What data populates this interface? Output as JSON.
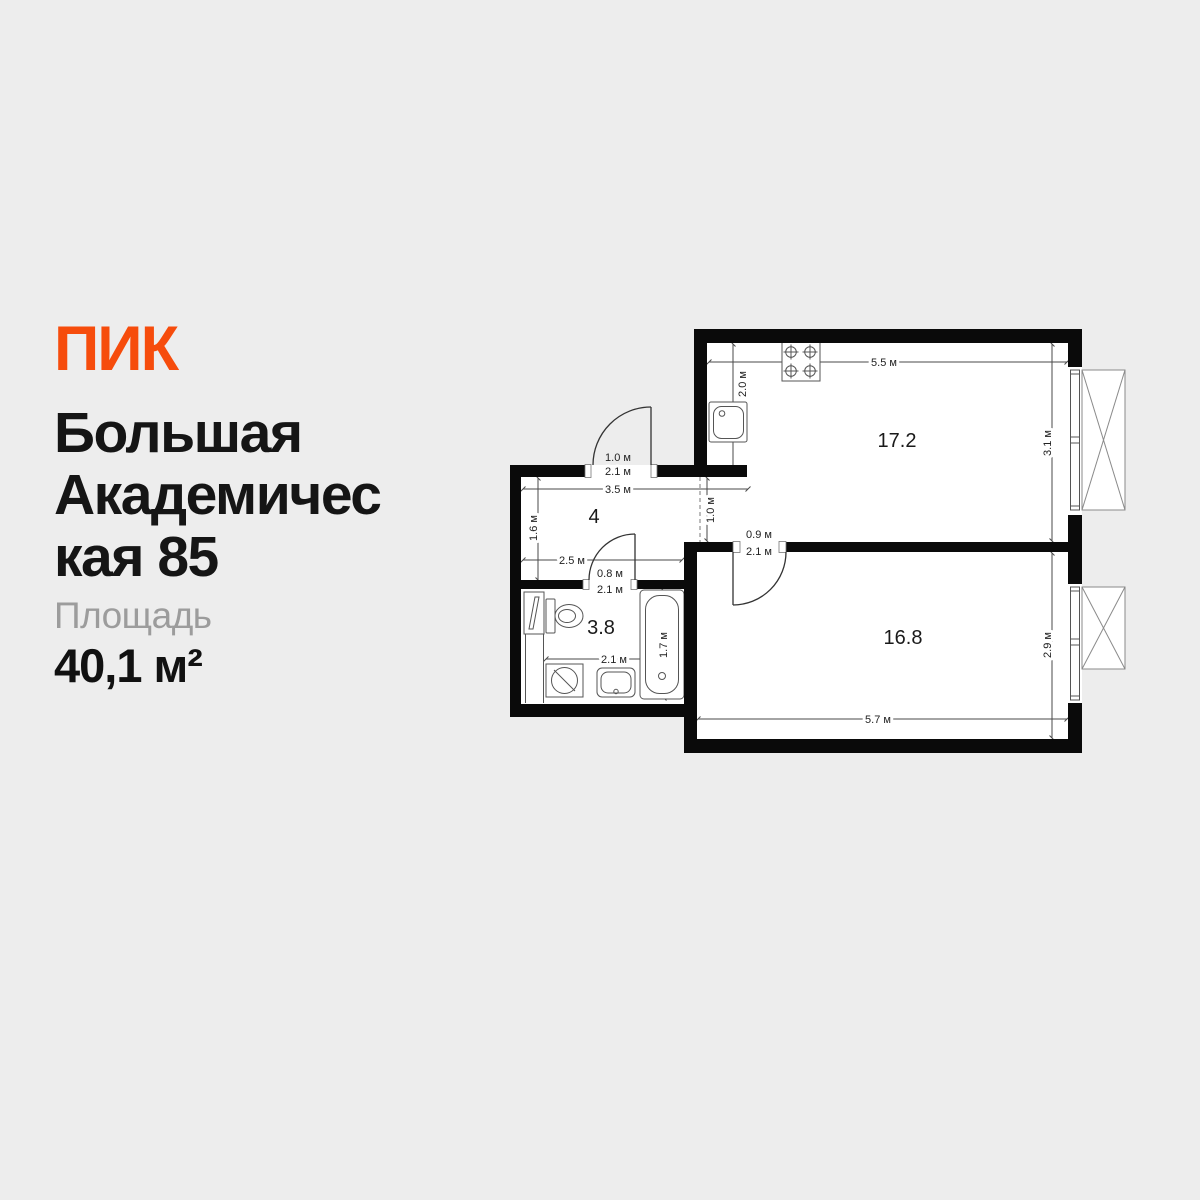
{
  "brand": {
    "logo_text": "ПИК",
    "logo_color": "#F64C0C"
  },
  "listing": {
    "address_lines": [
      "Большая",
      "Академичес",
      "кая 85"
    ],
    "area_label": "Площадь",
    "area_value": "40,1 м²"
  },
  "plan": {
    "areas": {
      "kitchen_living": "17.2",
      "hallway": "4",
      "bathroom": "3.8",
      "bedroom": "16.8"
    },
    "dims": {
      "kitchen_width": "5.5 м",
      "kitchen_nook_depth": "2.0 м",
      "kitchen_height": "3.1 м",
      "bedroom_width": "5.7 м",
      "bedroom_height": "2.9 м",
      "hall_width": "3.5 м",
      "hall_height": "1.6 м",
      "hall_lower_width": "2.5 м",
      "passage_width": "1.0 м",
      "bathroom_width": "2.1 м",
      "bathtub_length": "1.7 м"
    },
    "doors": {
      "entrance": {
        "w": "1.0 м",
        "h": "2.1 м"
      },
      "bedroom": {
        "w": "0.9 м",
        "h": "2.1 м"
      },
      "bathroom": {
        "w": "0.8 м",
        "h": "2.1 м"
      }
    },
    "colors": {
      "walls": "#0A0A0A",
      "floor": "#FFFFFF",
      "background": "#EDEDED"
    }
  }
}
